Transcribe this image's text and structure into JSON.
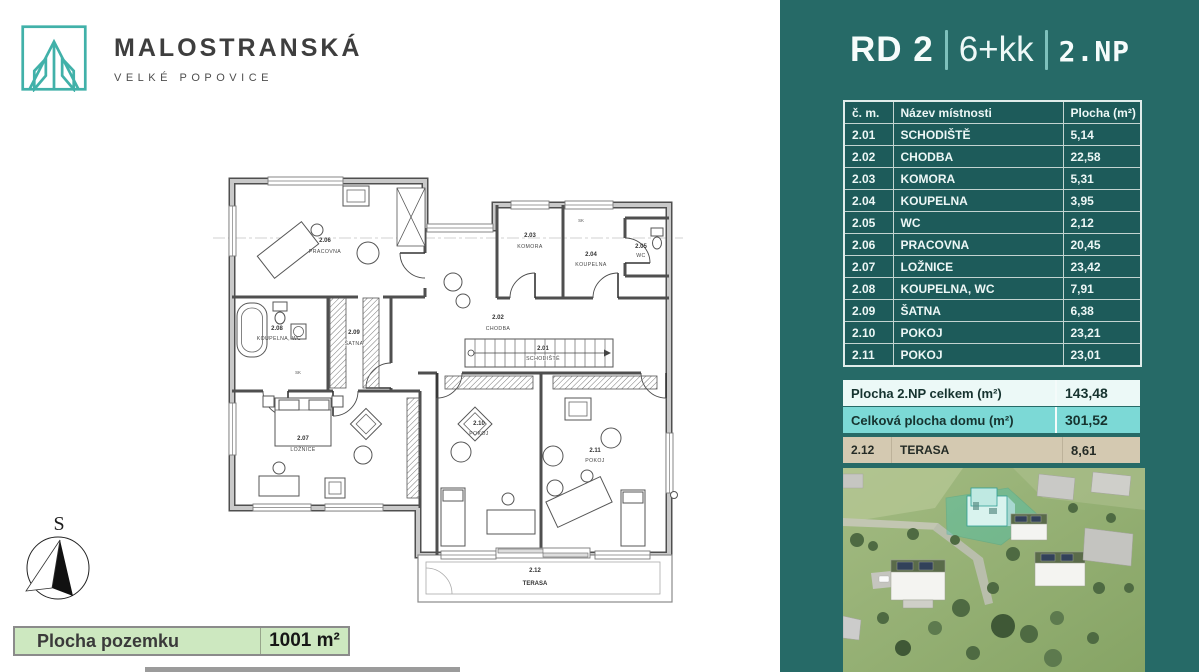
{
  "brand": {
    "name": "MALOSTRANSKÁ",
    "location": "VELKÉ POPOVICE"
  },
  "header": {
    "house": "RD 2",
    "disposition": "6+kk",
    "floor": "2.NP"
  },
  "rooms_table": {
    "headers": {
      "number": "č. m.",
      "name": "Název místnosti",
      "area": "Plocha (m²)"
    },
    "rows": [
      {
        "no": "2.01",
        "name": "SCHODIŠTĚ",
        "area": "5,14"
      },
      {
        "no": "2.02",
        "name": "CHODBA",
        "area": "22,58"
      },
      {
        "no": "2.03",
        "name": "KOMORA",
        "area": "5,31"
      },
      {
        "no": "2.04",
        "name": "KOUPELNA",
        "area": "3,95"
      },
      {
        "no": "2.05",
        "name": "WC",
        "area": "2,12"
      },
      {
        "no": "2.06",
        "name": "PRACOVNA",
        "area": "20,45"
      },
      {
        "no": "2.07",
        "name": "LOŽNICE",
        "area": "23,42"
      },
      {
        "no": "2.08",
        "name": "KOUPELNA, WC",
        "area": "7,91"
      },
      {
        "no": "2.09",
        "name": "ŠATNA",
        "area": "6,38"
      },
      {
        "no": "2.10",
        "name": "POKOJ",
        "area": "23,21"
      },
      {
        "no": "2.11",
        "name": "POKOJ",
        "area": "23,01"
      }
    ]
  },
  "summary": {
    "floor_total": {
      "label": "Plocha 2.NP celkem (m²)",
      "value": "143,48"
    },
    "house_total": {
      "label": "Celková plocha domu (m²)",
      "value": "301,52"
    }
  },
  "terrace": {
    "no": "2.12",
    "name": "TERASA",
    "area": "8,61"
  },
  "plot": {
    "label": "Plocha pozemku",
    "value": "1001 m²"
  },
  "compass": {
    "north_label": "S"
  },
  "floorplan": {
    "closet_label": "SK"
  },
  "colors": {
    "panel_teal": "#266a67",
    "table_cell_teal": "#1d5b5a",
    "summary_light": "#ecf9f7",
    "summary_cyan": "#7cd9d6",
    "terrace_tan": "#d4c9b1",
    "plot_green": "#cde8c0",
    "brand_teal": "#41b1a9",
    "highlight_house_teal": "#3ec3b4"
  }
}
